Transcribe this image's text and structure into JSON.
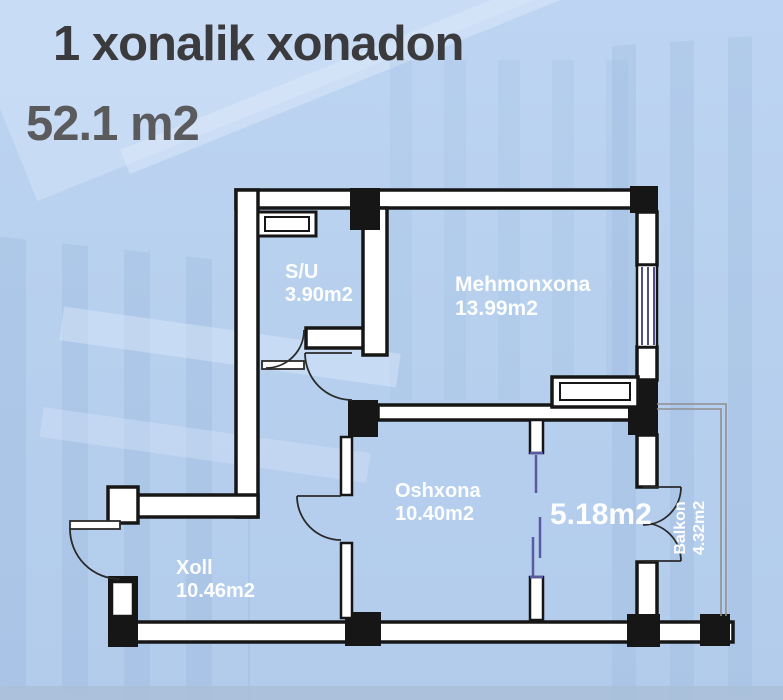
{
  "title": {
    "line1": "1 xonalik xonadon",
    "line2": "52.1 m2"
  },
  "rooms": {
    "su": {
      "name": "S/U",
      "area": "3.90m2"
    },
    "mehmonxona": {
      "name": "Mehmonxona",
      "area": "13.99m2"
    },
    "oshxona": {
      "name": "Oshxona",
      "area": "10.40m2"
    },
    "xoll": {
      "name": "Xoll",
      "area": "10.46m2"
    },
    "room5": {
      "area": "5.18m2"
    },
    "balkon": {
      "name": "Balkon",
      "area": "4.32m2"
    }
  },
  "colors": {
    "background": "#b7d0ee",
    "wall_fill": "#ffffff",
    "wall_stroke": "#161616",
    "window_glass_lines": "#4e4e8a",
    "sliding_door": "#5a5aa0",
    "balcony_rail": "#8f8f8f",
    "label_text": "#ffffff",
    "title_primary": "#3b3b3d",
    "title_secondary": "#5b5b5e"
  }
}
